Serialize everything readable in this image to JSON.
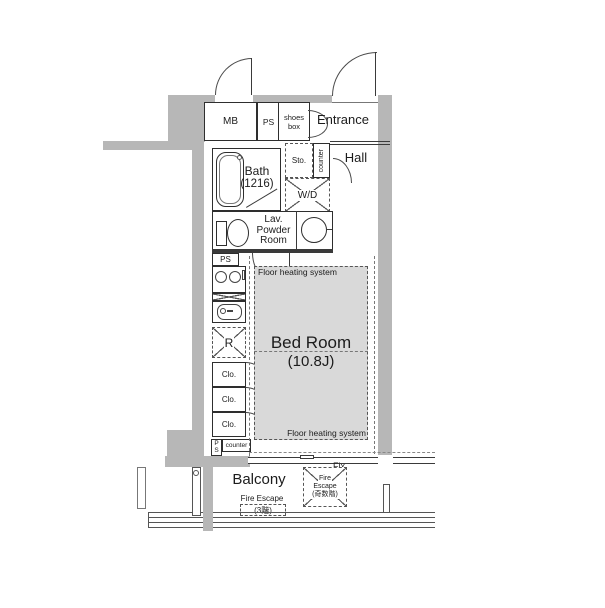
{
  "colors": {
    "wall": "#b7b7b7",
    "floor_heating_fill": "#d9d9d9",
    "line": "#2e2e2e"
  },
  "labels": {
    "mb": "MB",
    "ps_top": "PS",
    "shoes_box_1": "shoes",
    "shoes_box_2": "box",
    "entrance": "Entrance",
    "sto": "Sto.",
    "counter_hall": "counter",
    "hall": "Hall",
    "wd": "W/D",
    "bath_1": "Bath",
    "bath_2": "(1216)",
    "lav_1": "Lav.",
    "lav_2": "Powder",
    "lav_3": "Room",
    "ps_mid": "PS",
    "refrigerator": "R",
    "clo": "Clo.",
    "ps_bottom_1": "P",
    "ps_bottom_2": "S",
    "counter_bottom": "counter",
    "floor_heating": "Floor heating system",
    "bedroom_name": "Bed Room",
    "bedroom_size": "(10.8J)",
    "fix": "Fix",
    "balcony": "Balcony",
    "fire_hatch_1": "Fire",
    "fire_hatch_2": "Escape",
    "fire_hatch_3": "(奇数階)",
    "fire_escape_3f_1": "Fire Escape",
    "fire_escape_3f_2": "(3階)"
  }
}
